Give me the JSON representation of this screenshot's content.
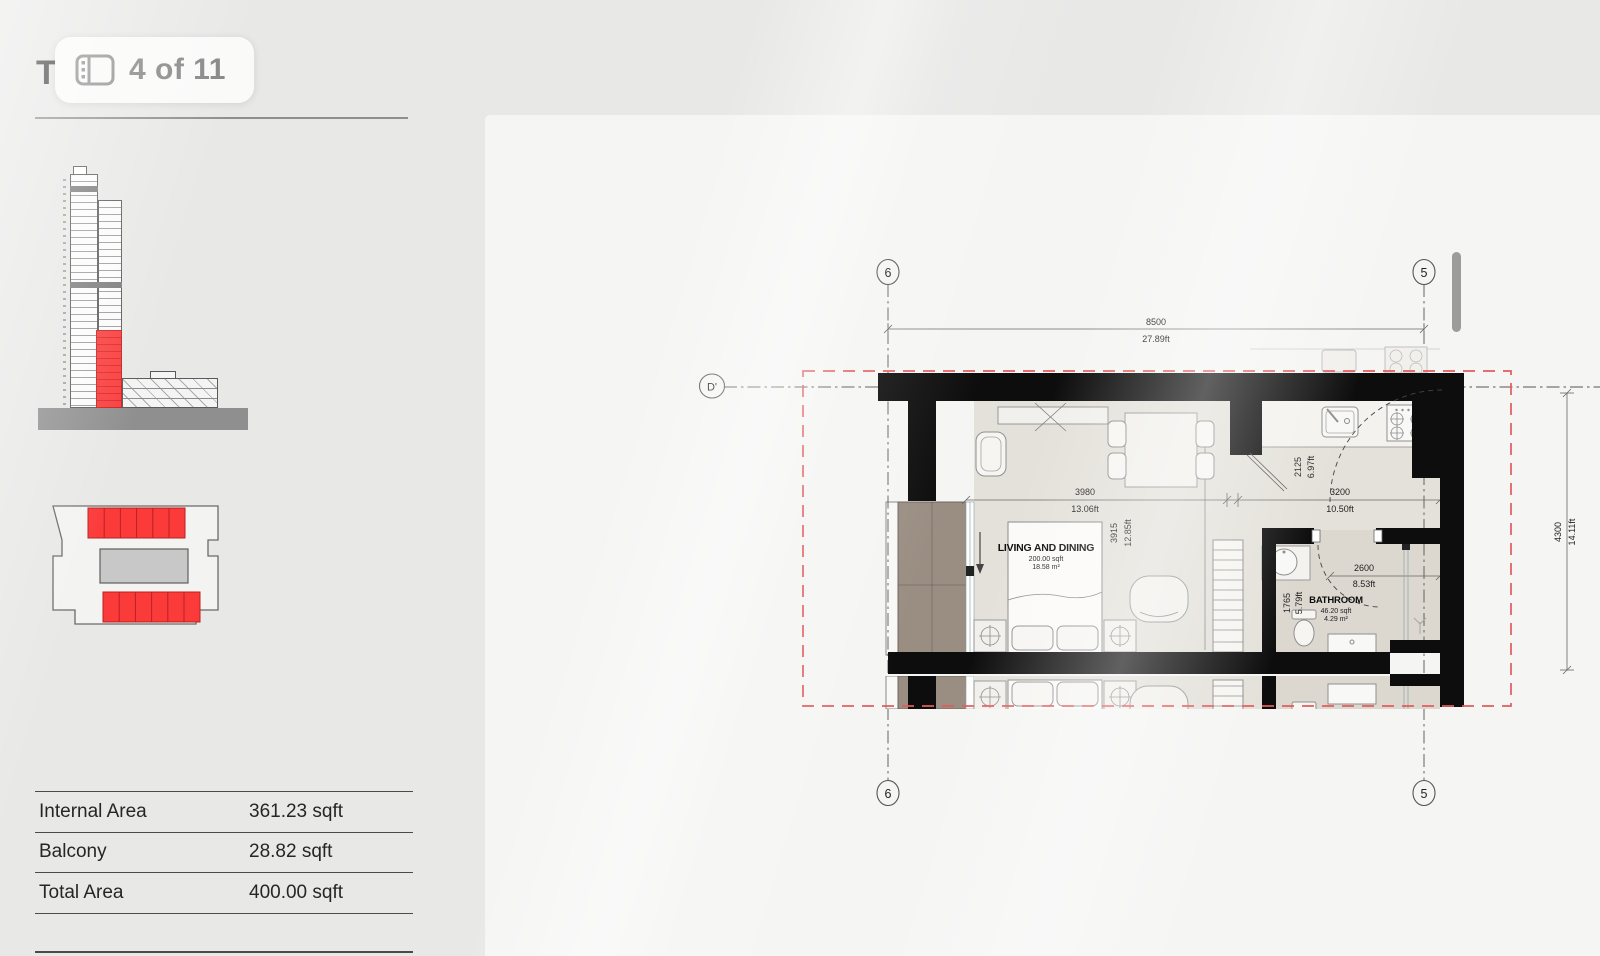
{
  "header": {
    "hidden_title": "T",
    "pagination": "4 of 11"
  },
  "sidebar": {
    "area_rows": [
      {
        "label": "Internal Area",
        "value": "361.23 sqft"
      },
      {
        "label": "Balcony",
        "value": "28.82 sqft"
      },
      {
        "label": "Total Area",
        "value": "400.00 sqft"
      }
    ]
  },
  "diagrams": {
    "elevation_highlight_color": "#f93b3b",
    "floor_plate": {
      "units_top": 6,
      "units_bottom": 6,
      "unit_color": "#f93b3b",
      "core_color": "#c8c8c8"
    }
  },
  "plan": {
    "grid": {
      "col_left": "6",
      "col_right": "5",
      "row_left": "D'"
    },
    "rooms": {
      "living": {
        "name": "LIVING AND DINING",
        "sqft": "200.00 sqft",
        "m2": "18.58 m²"
      },
      "bath": {
        "name": "BATHROOM",
        "sqft": "46.20 sqft",
        "m2": "4.29 m²"
      }
    },
    "dims": {
      "total_w_mm": "8500",
      "total_w_ft": "27.89ft",
      "total_h_mm": "4300",
      "total_h_ft": "14.11ft",
      "living_w_mm": "3980",
      "living_w_ft": "13.06ft",
      "living_h_mm": "3915",
      "living_h_ft": "12.85ft",
      "kitchen_h_mm": "2125",
      "kitchen_h_ft": "6.97ft",
      "kitchen_w_mm": "3200",
      "kitchen_w_ft": "10.50ft",
      "bath_w_mm": "2600",
      "bath_w_ft": "8.53ft",
      "bath_h_mm": "1765",
      "bath_h_ft": "5.79ft"
    },
    "colors": {
      "wall": "#0d0d0d",
      "floor": "#e4e1da",
      "bath_floor": "#dcd8d0",
      "balcony": "#9a8e83",
      "boundary_dashed": "#e25c5c"
    }
  }
}
